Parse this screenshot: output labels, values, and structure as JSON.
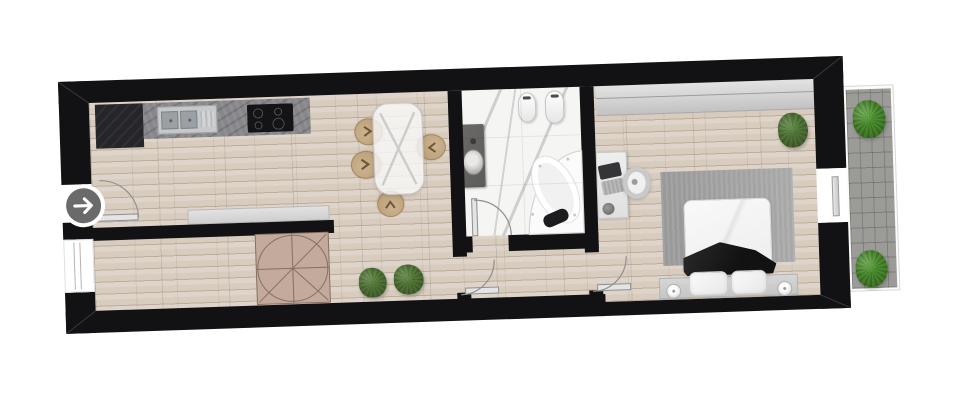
{
  "scene": {
    "kind": "apartment-floor-plan",
    "orientation": "long horizontal strip, slightly rotated counter-clockwise",
    "rotation_deg": -1.9,
    "has_text": false
  },
  "items": {
    "entrance": "entrance-arrow",
    "entry_door": "entry-door",
    "living": "living-room-kitchen",
    "kitchen_counter": "kitchen-counter",
    "sink": "double-sink-with-drainboard",
    "cooktop": "induction-cooktop",
    "dining_table": "glass-dining-table",
    "dining_chair": "wicker-dining-chair",
    "sideboard": "sideboard",
    "hallway": "hallway",
    "round_table": "round-table",
    "plant": "potted-plant",
    "window": "window",
    "bathroom": "bathroom",
    "vanity": "vanity-with-vessel-sink",
    "toilet": "toilet",
    "bidet": "bidet",
    "bathtub": "corner-whirlpool-bathtub",
    "bathroom_door": "bathroom-door",
    "hall_door_left": "hallway-door-to-living-room",
    "hall_door_right": "hallway-door-to-bedroom",
    "bedroom": "bedroom",
    "bedroom_window": "bedroom-window",
    "desk": "desk",
    "laptop": "laptop",
    "desk_chair": "desk-chair",
    "rug": "area-rug",
    "bed": "double-bed",
    "bench": "headboard-with-nightstands",
    "pillow": "pillow",
    "lamp": "table-lamp",
    "balcony": "balcony",
    "balcony_door": "balcony-sliding-door"
  },
  "rooms": [
    {
      "id": "living-kitchen",
      "furniture": [
        "kitchen-counter",
        "double-sink",
        "cooktop",
        "dining-table",
        "four-chairs",
        "sideboard",
        "entry-door"
      ]
    },
    {
      "id": "hallway",
      "furniture": [
        "round-table",
        "two-plants",
        "window"
      ]
    },
    {
      "id": "bathroom",
      "furniture": [
        "vanity-sink",
        "toilet",
        "bidet",
        "corner-bathtub",
        "door"
      ]
    },
    {
      "id": "bedroom",
      "furniture": [
        "desk",
        "laptop",
        "desk-chair",
        "rug",
        "double-bed",
        "headboard-bench",
        "two-pillows",
        "two-lamps",
        "plant",
        "window"
      ]
    },
    {
      "id": "balcony",
      "furniture": [
        "pavers",
        "two-plants",
        "sliding-door"
      ]
    }
  ],
  "colors": {
    "wall": "#121214",
    "wood-light": "#ded4c9",
    "wood-seam": "#bcae9e",
    "marble": "#f5f5f3",
    "granite": "#87878b",
    "granite-dark": "#26262a",
    "cooktop": "#141416",
    "steel": "#c7c8ca",
    "steel-bowl": "#9aa0a4",
    "glass-table": "rgba(250,250,250,0.78)",
    "chair-tan": "#cdb491",
    "sideboard": "#cfcfcf",
    "round-table": "#c3aa9c",
    "round-table-line": "#86705f",
    "plant-dark": "#44612f",
    "plant-mid": "#5f8c40",
    "plant-bright": "#58a438",
    "rug": "#a2a2a2",
    "bed-white": "#ededed",
    "blanket": "#121212",
    "bench": "#c6c6c6",
    "window-glass": "#d2d2d2",
    "paver": "#9b9b98",
    "vanity": "#5d5c5a",
    "desk": "#e0e0e0",
    "door-leaf": "#e4e4e4",
    "door-arc": "#8f8f8f",
    "entrance-bg": "#6a6a6a",
    "tub": "#fbfbfb"
  }
}
